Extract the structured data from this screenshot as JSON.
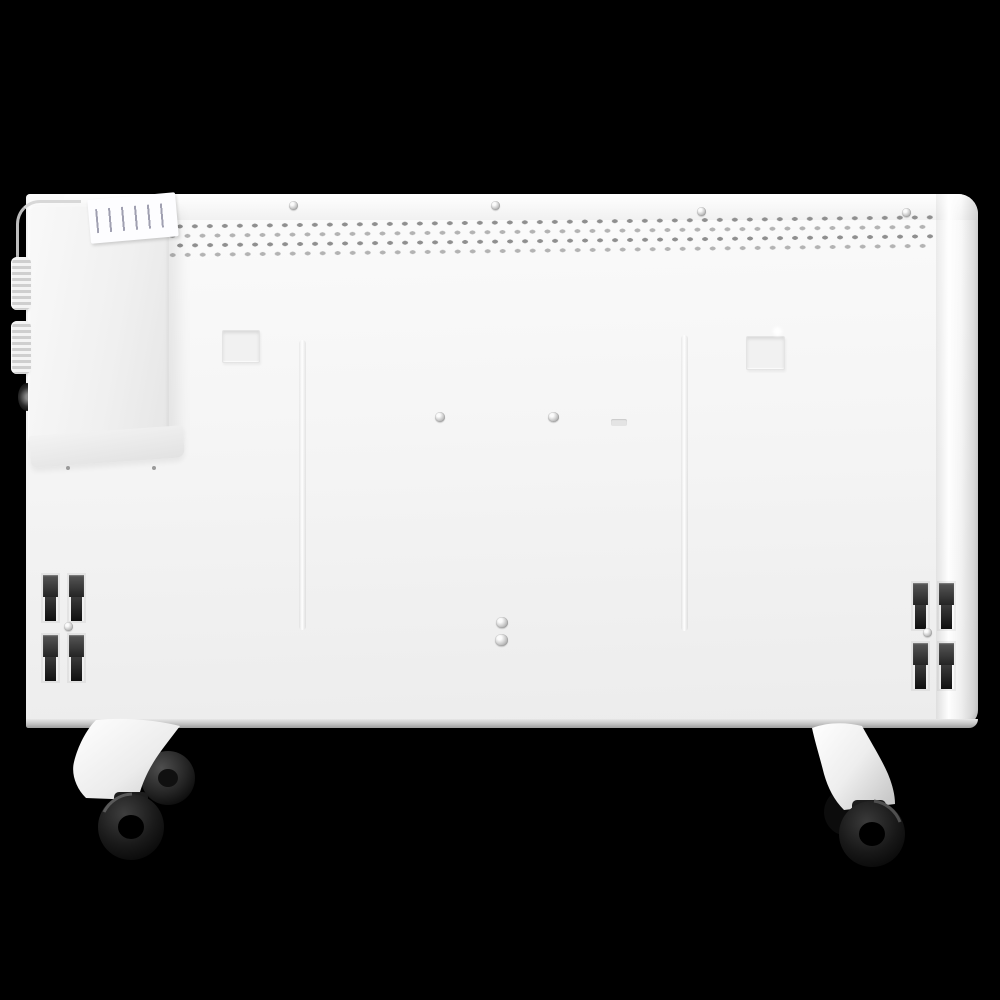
{
  "meta": {
    "type": "product-photo",
    "description": "Rear view of a white electric panel convector heater on a black background: perforated air-vent strip along the top edge, a side control housing with two ridged knobs and a white spec label, two recessed wall-mount slots, two groups of four dark mounting clips, assembly screws, and two white caster brackets with twin black wheels."
  },
  "colors": {
    "background": "#000000",
    "panel_body": "#f3f3f3",
    "panel_bottom_edge": "#9d9d9d",
    "vent_hole": "#8f8f8f",
    "label": "#fdfdff",
    "clip": "#2b2b2b",
    "wheel": "#141414",
    "screw": "#b5b5b5"
  },
  "counts": {
    "vent_hole_rows": 4,
    "top_edge_screws": 4,
    "center_screws": 2,
    "lower_center_screws": 2,
    "wall_mount_slots": 2,
    "mount_clips_left": 4,
    "mount_clips_right": 4,
    "control_knobs": 2,
    "casters": 2,
    "wheels_per_caster": 2
  },
  "label": {
    "legible": false
  }
}
